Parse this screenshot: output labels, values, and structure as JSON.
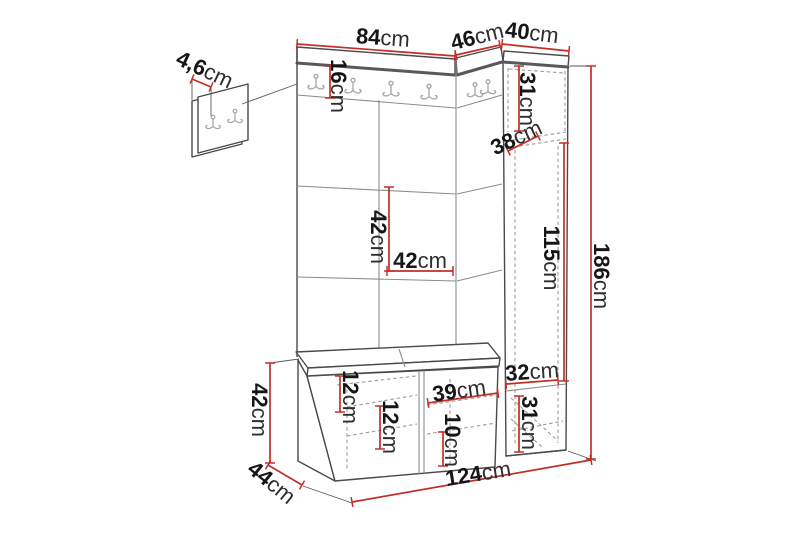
{
  "diagram": {
    "title": "hallway-furniture-dimension-diagram",
    "unit": "cm",
    "accent_color": "#c22f28",
    "line_color": "#4a4a4a"
  },
  "labels": {
    "top_left_width": {
      "value": "84",
      "unit": "cm"
    },
    "top_middle_width": {
      "value": "46",
      "unit": "cm"
    },
    "top_column_width": {
      "value": "40",
      "unit": "cm"
    },
    "wall_panel_thickness": {
      "value": "4,6",
      "unit": "cm"
    },
    "hook_rail_height": {
      "value": "16",
      "unit": "cm"
    },
    "column_top_section": {
      "value": "31",
      "unit": "cm"
    },
    "column_depth": {
      "value": "38",
      "unit": "cm"
    },
    "panel_height": {
      "value": "42",
      "unit": "cm"
    },
    "panel_width": {
      "value": "42",
      "unit": "cm"
    },
    "column_middle_section": {
      "value": "115",
      "unit": "cm"
    },
    "total_height": {
      "value": "186",
      "unit": "cm"
    },
    "bench_height": {
      "value": "42",
      "unit": "cm"
    },
    "bench_depth": {
      "value": "44",
      "unit": "cm"
    },
    "bench_top_clearance": {
      "value": "12",
      "unit": "cm"
    },
    "bench_shelf_clearance": {
      "value": "12",
      "unit": "cm"
    },
    "bench_door_width": {
      "value": "39",
      "unit": "cm"
    },
    "bench_lower_clearance": {
      "value": "10",
      "unit": "cm"
    },
    "column_shelf_width": {
      "value": "32",
      "unit": "cm"
    },
    "column_bottom_section": {
      "value": "31",
      "unit": "cm"
    },
    "total_width": {
      "value": "124",
      "unit": "cm"
    }
  }
}
